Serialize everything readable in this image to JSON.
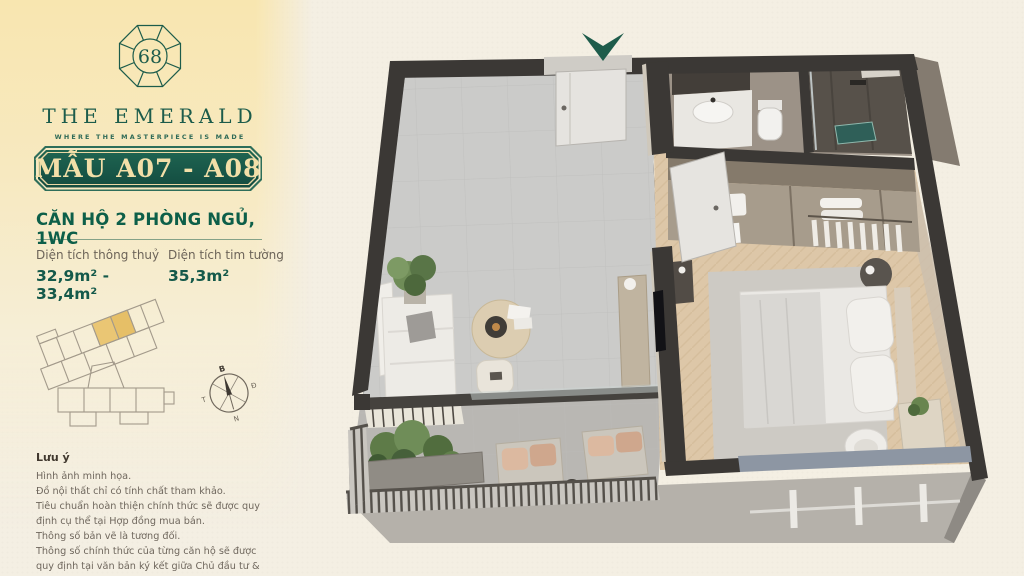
{
  "brand": {
    "logo_number": "68",
    "name": "THE EMERALD",
    "tagline": "WHERE THE MASTERPIECE IS MADE"
  },
  "unit": {
    "badge": "MẪU A07 - A08",
    "type_title": "CĂN HỘ 2 PHÒNG NGỦ, 1WC",
    "areas": [
      {
        "label": "Diện tích thông thuỷ",
        "value": "32,9m² - 33,4m²"
      },
      {
        "label": "Diện tích tim tường",
        "value": "35,3m²"
      }
    ]
  },
  "compass": {
    "north": "B",
    "east": "Đ",
    "south": "N",
    "west": "T"
  },
  "notes": {
    "title": "Lưu ý",
    "lines": [
      "Hình ảnh minh họa.",
      "Đồ nội thất chỉ có tính chất tham khảo.",
      "Tiêu chuẩn hoàn thiện chính thức sẽ được quy định cụ thể tại Hợp đồng mua bán.",
      "Thông số bản vẽ là tương đối.",
      "Thông số chính thức của từng căn hộ sẽ được quy định tại văn bản ký kết giữa Chủ đầu tư & khách hàng."
    ]
  },
  "colors": {
    "accent_green": "#17594a",
    "badge_text": "#f2dfa8",
    "gold_highlight": "#eac674",
    "sidebar_gold": "#f8e6b0",
    "background": "#f4efe3",
    "wall": "#3b3835",
    "living_floor": "#cccccа",
    "bedroom_floor": "#ddc7a8",
    "entry_arrow": "#1e5c4b"
  }
}
